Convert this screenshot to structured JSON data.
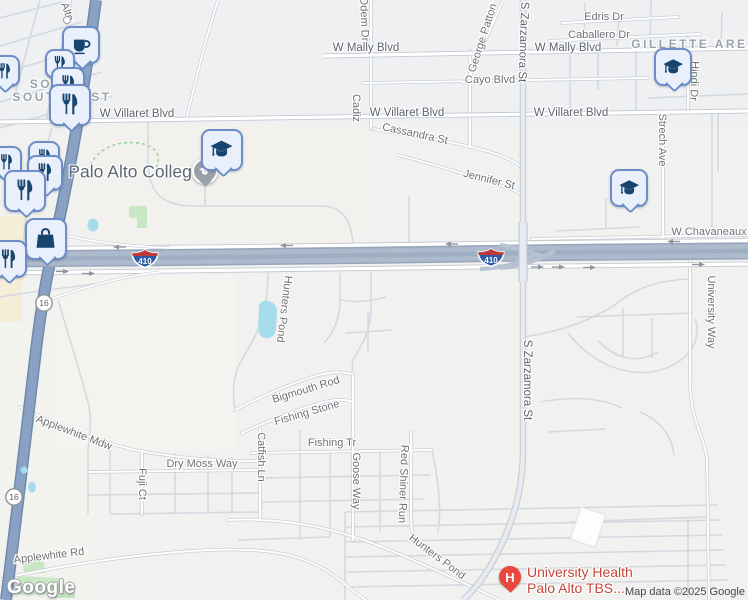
{
  "attribution": {
    "logo": "Google",
    "map_data": "Map data ©2025 Google"
  },
  "neighborhoods": {
    "south": {
      "line1": "SOUTH",
      "line2": "SOUTHWEST"
    },
    "gillette": "GILLETTE AREA"
  },
  "pois": {
    "college": {
      "name": "Palo Alto College",
      "icon": "graduation-cap-badge"
    },
    "hospital": {
      "line1": "University Health",
      "line2": "Palo Alto TBS...",
      "badge": "H",
      "icon": "hospital-h"
    }
  },
  "shields": {
    "i410": "410",
    "sh16": "16"
  },
  "streets": {
    "mally_left": "W Mally Blvd",
    "mally_right": "W Mally Blvd",
    "edris": "Edris Dr",
    "caballero": "Caballero Dr",
    "cayo": "Cayo Blvd",
    "villaret_left": "W Villaret Blvd",
    "villaret_mid": "W Villaret Blvd",
    "villaret_right": "W Villaret Blvd",
    "cassandra": "Cassandra St",
    "jennifer": "Jennifer St",
    "odem": "Odem Dr",
    "cadiz": "Cadiz",
    "george_patton": "George Patton",
    "alto": "Alto",
    "zarzamora_top": "S Zarzamora St",
    "zarzamora_mid": "S Zarzamora St",
    "chavaneaux": "W Chavaneaux",
    "hindi": "Hindi Dr",
    "strech": "Strech Ave",
    "university_way": "University Way",
    "hunters_pond_upper": "Hunters Pond",
    "hunters_pond_lower": "Hunters Pond",
    "bigmouth": "Bigmouth Rod",
    "fishing_stone": "Fishing Stone",
    "fishing_tr": "Fishing Tr",
    "goose": "Goose Way",
    "red_shiner": "Red Shiner Run",
    "catfish": "Catfish Ln",
    "fuji": "Fuji Ct",
    "dry_moss": "Dry Moss Way",
    "applewhite_mdw": "Applewhite Mdw",
    "applewhite_rd": "Applewhite Rd"
  },
  "icons": {
    "cafe": "coffee-cup",
    "restaurant": "fork-and-knife",
    "shopping": "shopping-bag",
    "education": "graduation-cap",
    "hospital": "hospital-h"
  },
  "colors": {
    "highway_blue": "#89a2c4",
    "interstate_band": "#adbacc",
    "water": "#a6dcec",
    "park": "#c9e7c4",
    "pin_fill": "#e9effb",
    "pin_border": "#6d8dc9",
    "pin_glyph": "#17456e",
    "hospital_red": "#e8483d",
    "hospital_label_red": "#c5463c"
  }
}
